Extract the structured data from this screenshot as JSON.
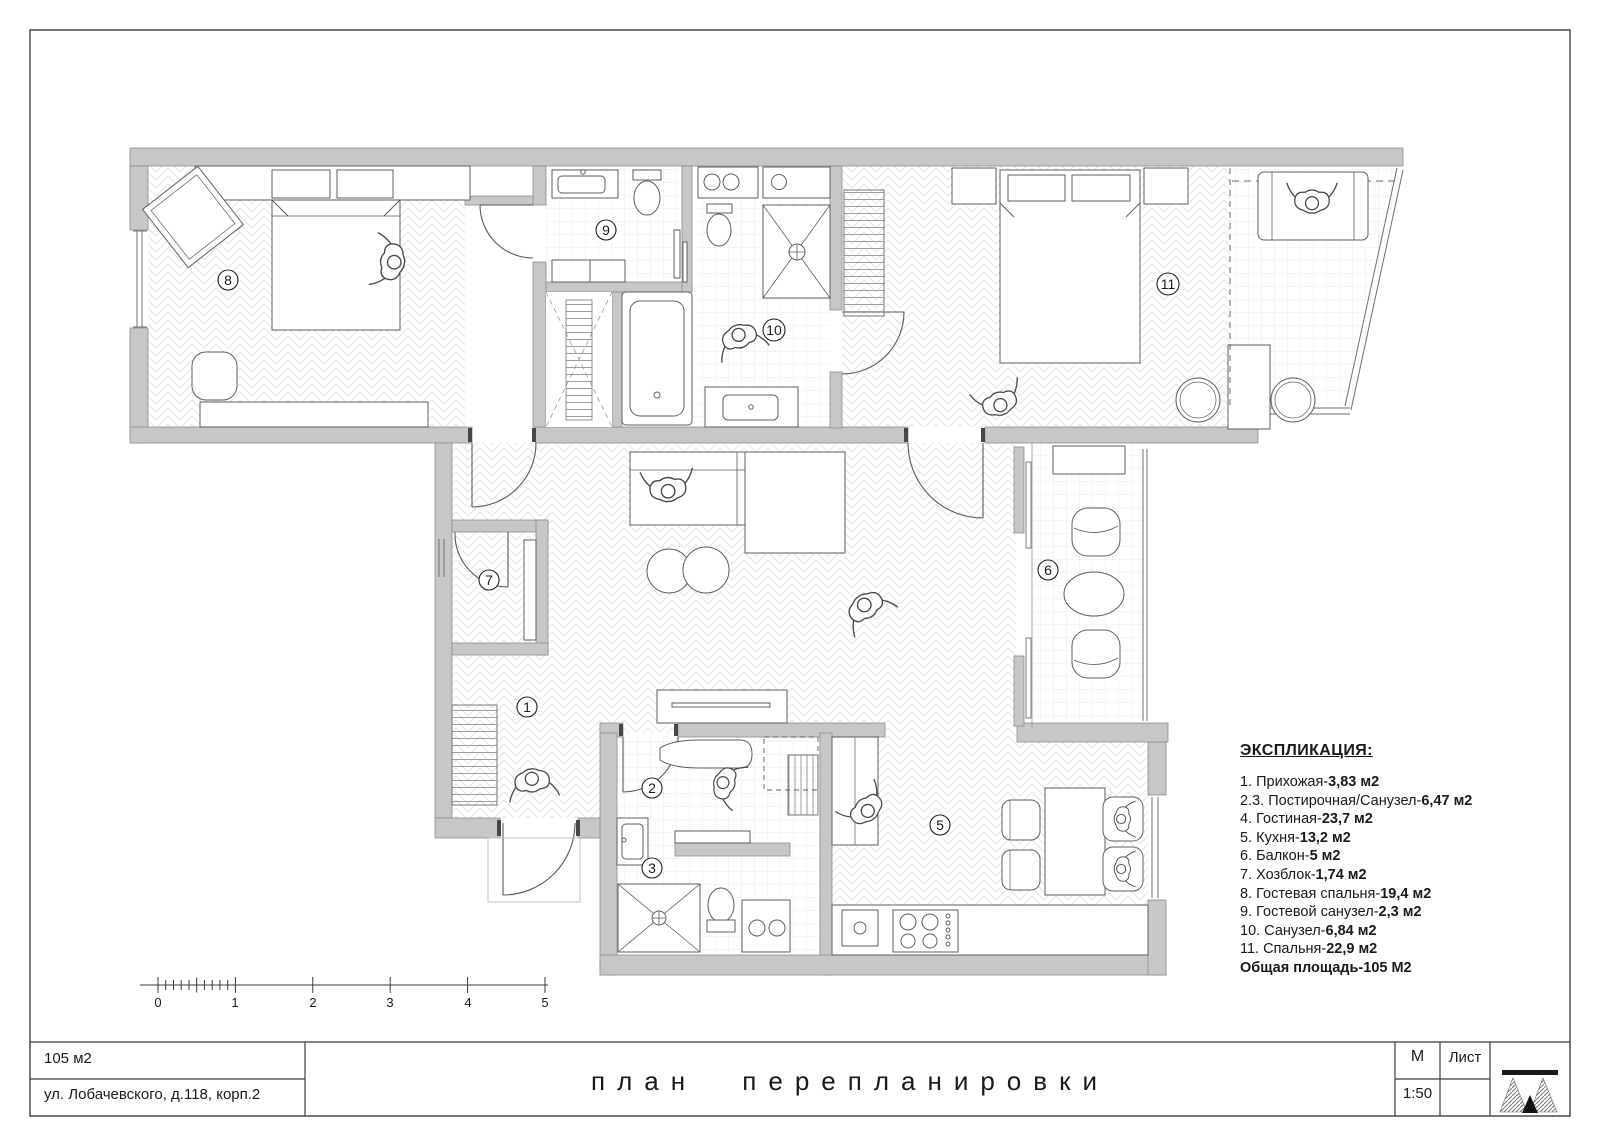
{
  "legend": {
    "title": "ЭКСПЛИКАЦИЯ:",
    "items": [
      {
        "label": "1. Прихожая-",
        "area": "3,83 м2"
      },
      {
        "label": "2.3. Постирочная/Санузел-",
        "area": "6,47 м2"
      },
      {
        "label": "4. Гостиная-",
        "area": "23,7 м2"
      },
      {
        "label": "5. Кухня-",
        "area": "13,2 м2"
      },
      {
        "label": "6. Балкон-",
        "area": "5 м2"
      },
      {
        "label": "7. Хозблок-",
        "area": "1,74 м2"
      },
      {
        "label": "8. Гостевая спальня-",
        "area": "19,4 м2"
      },
      {
        "label": "9. Гостевой санузел-",
        "area": "2,3 м2"
      },
      {
        "label": "10. Санузел-",
        "area": "6,84 м2"
      },
      {
        "label": "11. Спальня-",
        "area": "22,9 м2"
      }
    ],
    "total": "Общая площадь-105 М2"
  },
  "plan": {
    "room_labels": [
      "1",
      "2",
      "3",
      "5",
      "6",
      "7",
      "8",
      "9",
      "10",
      "11"
    ]
  },
  "scale_bar": {
    "labels": [
      "0",
      "1",
      "2",
      "3",
      "4",
      "5"
    ]
  },
  "title_block": {
    "area": "105 м2",
    "address": "ул. Лобачевского, д.118, корп.2",
    "title": "план перепланировки",
    "scale_label": "М",
    "scale_value": "1:50",
    "sheet_label": "Лист"
  }
}
